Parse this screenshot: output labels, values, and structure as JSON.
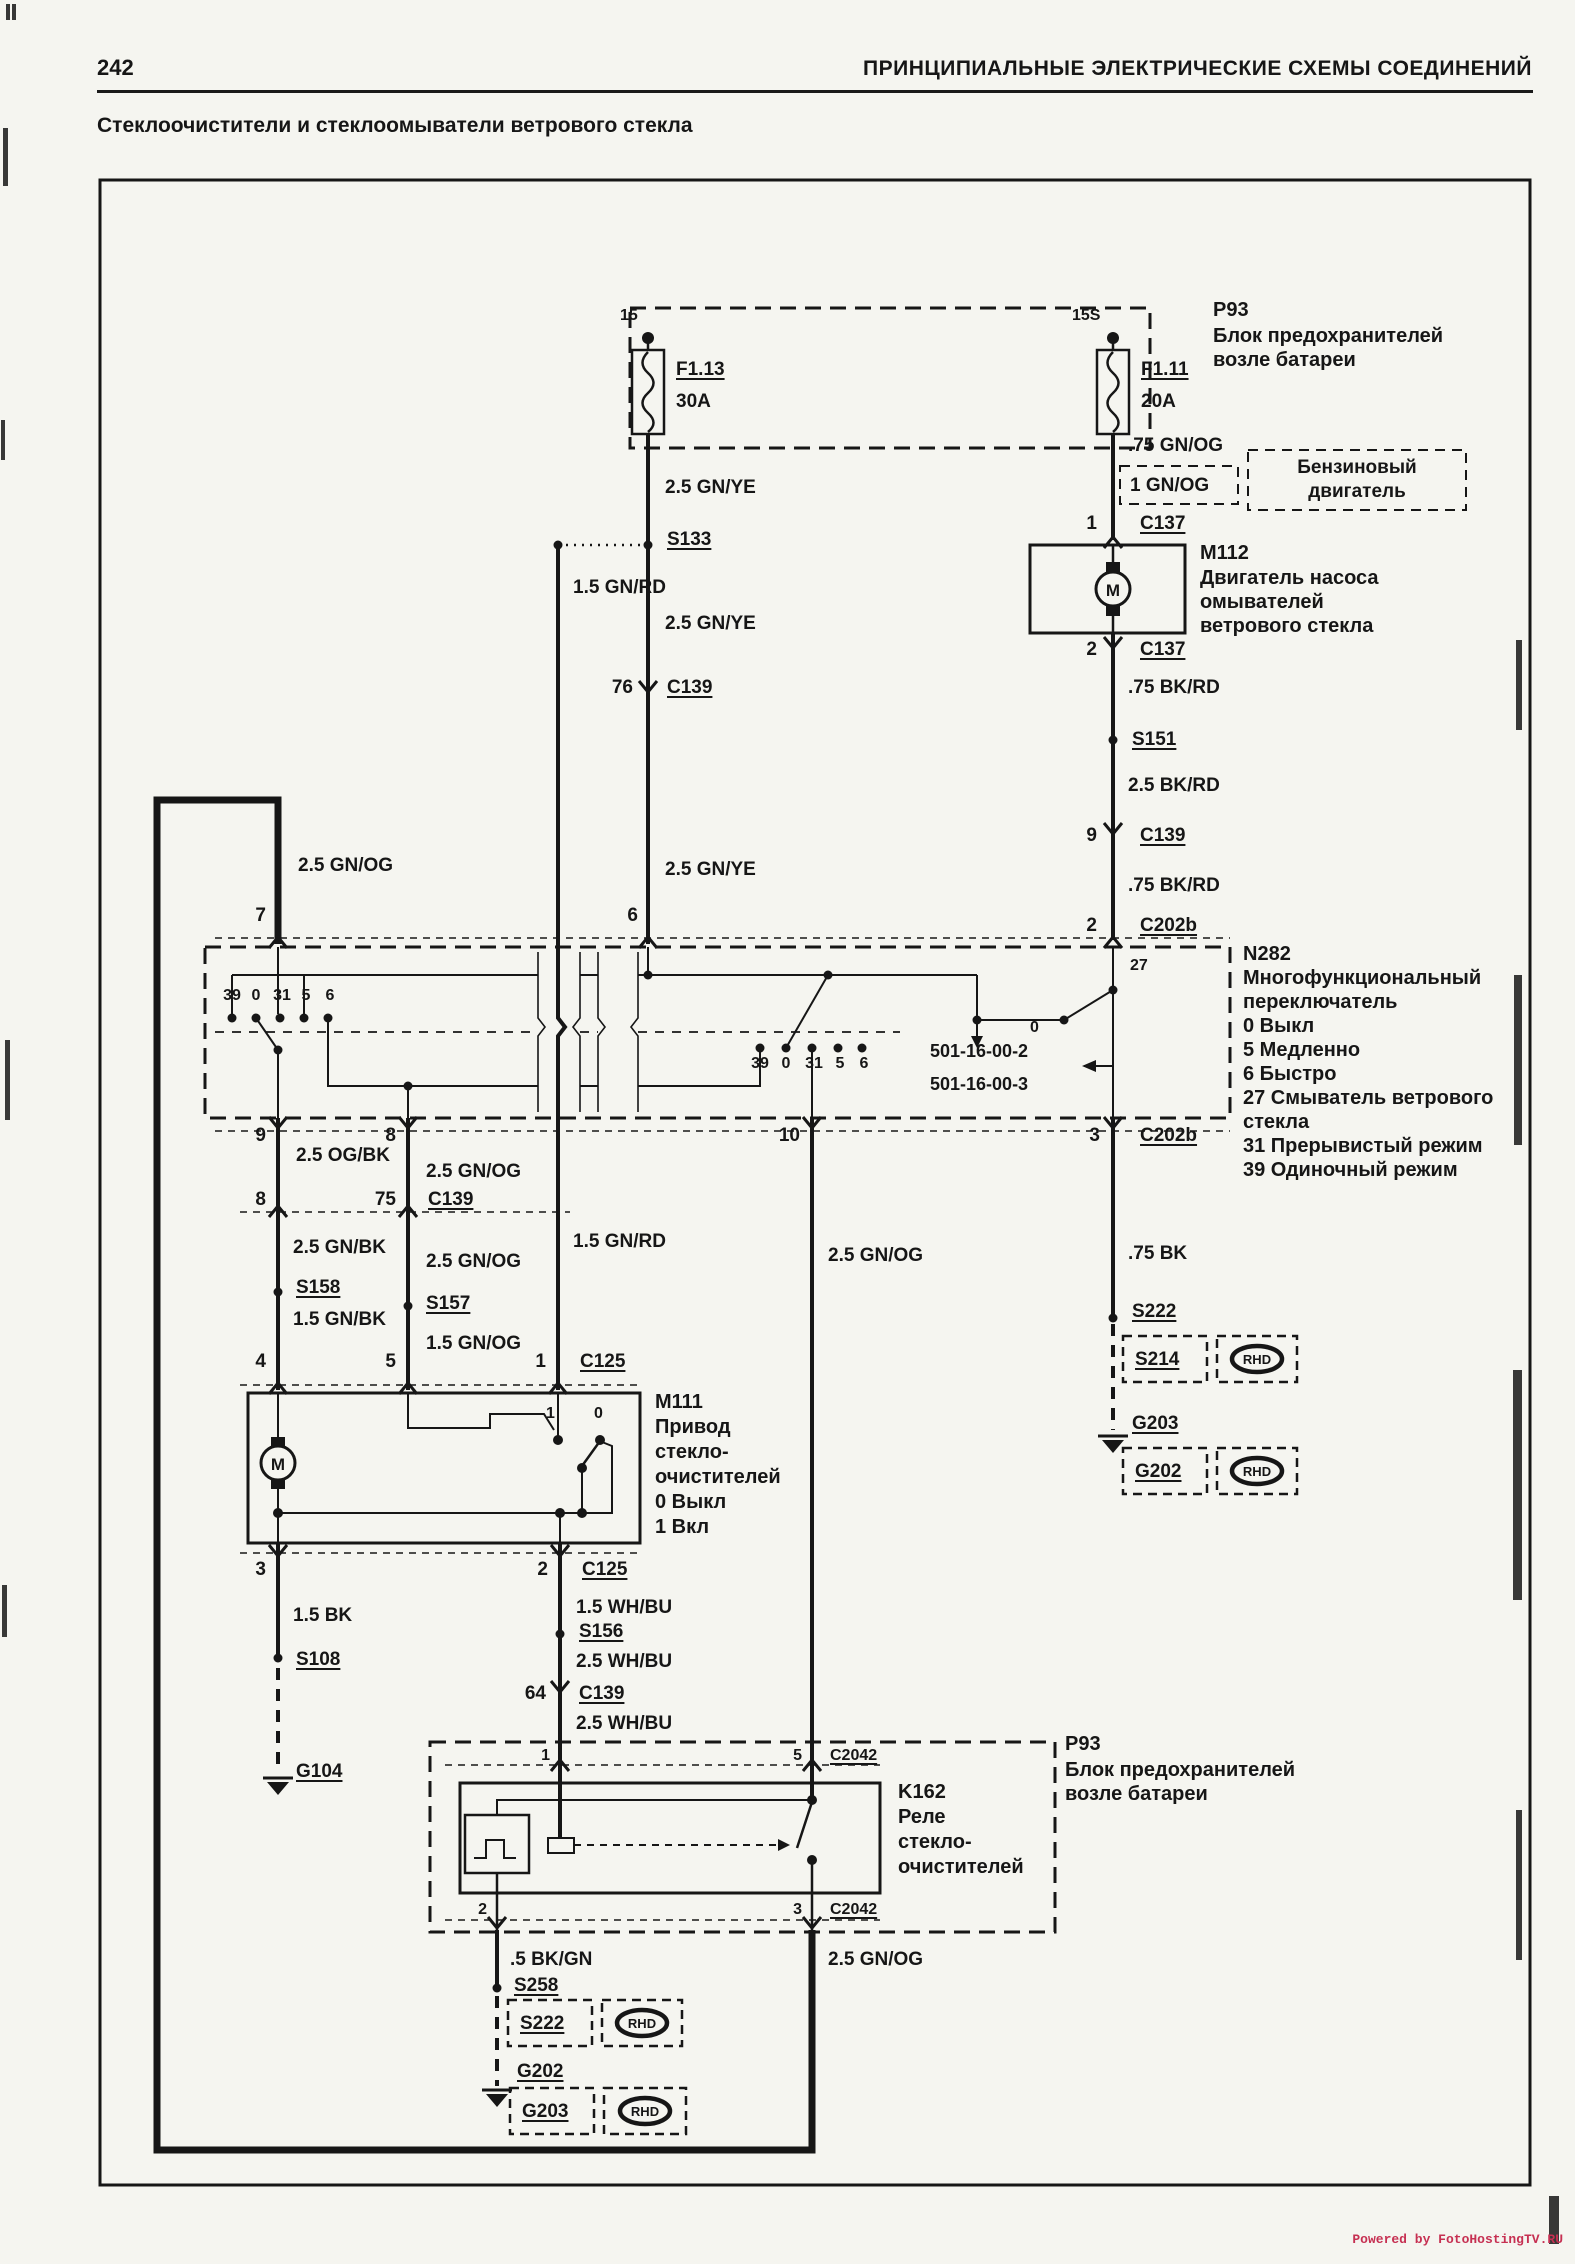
{
  "page": {
    "number": "242",
    "header": "ПРИНЦИПИАЛЬНЫЕ ЭЛЕКТРИЧЕСКИЕ СХЕМЫ СОЕДИНЕНИЙ",
    "title": "Стеклоочистители и стеклоомыватели ветрового стекла",
    "watermark": "Powered by FotoHostingTV.RU"
  },
  "colors": {
    "ink": "#161616",
    "paper": "#f5f5f0",
    "watermark": "#c63052"
  },
  "fusebox_top": {
    "id": "P93",
    "desc_line1": "Блок предохранителей",
    "desc_line2": "возле батареи",
    "fuse_left": {
      "terminal": "15",
      "name": "F1.13",
      "rating": "30A"
    },
    "fuse_right": {
      "terminal": "15S",
      "name": "F1.11",
      "rating": "20A"
    }
  },
  "washer_branch": {
    "wire_up": ".75 GN/OG",
    "wire_alt": "1 GN/OG",
    "engine_note_line1": "Бензиновый",
    "engine_note_line2": "двигатель",
    "pin_top": "1",
    "pin_bottom": "2",
    "connector_top": "C137",
    "connector_bottom": "C137",
    "motor": {
      "id": "M112",
      "symbol": "M",
      "desc_line1": "Двигатель насоса",
      "desc_line2": "омывателей",
      "desc_line3": "ветрового стекла"
    },
    "wire1": ".75 BK/RD",
    "splice": "S151",
    "wire2": "2.5 BK/RD",
    "pin_c139": "9",
    "conn_c139": "C139",
    "wire3": ".75 BK/RD",
    "pin_c202b": "2",
    "conn_c202b": "C202b"
  },
  "wiper_feed": {
    "wire1": "2.5 GN/YE",
    "splice": "S133",
    "wire2": "2.5 GN/YE",
    "pin_c139": "76",
    "conn_c139": "C139",
    "wire3": "2.5 GN/YE",
    "pin_n282": "6",
    "branch_wire": "1.5 GN/RD",
    "branch_wire2": "1.5 GN/RD"
  },
  "bus": {
    "wire_label_top": "2.5 GN/OG",
    "pin_n282": "7",
    "wire_label_bottom": "2.5 GN/OG"
  },
  "n282": {
    "id": "N282",
    "desc_line1": "Многофункциональный",
    "desc_line2": "переключатель",
    "legend": [
      "0 Выкл",
      "5 Медленно",
      "6 Быстро",
      "27 Смыватель ветрового",
      "стекла",
      "31 Прерывистый режим",
      "39 Одиночный режим"
    ],
    "sw1": [
      "39",
      "0",
      "31",
      "5",
      "6"
    ],
    "sw2": [
      "39",
      "0",
      "31",
      "5",
      "6"
    ],
    "washer_pin": "27",
    "washer_off": "0",
    "ref1": "501-16-00-2",
    "ref2": "501-16-00-3",
    "out_row": {
      "pin9": "9",
      "pin8": "8",
      "pin10": "10",
      "pin3": "3",
      "connector": "C202b"
    }
  },
  "motor_circuit": {
    "colA": {
      "wire1": "2.5 OG/BK",
      "pin_c139": "8",
      "wire2": "2.5 GN/BK",
      "splice": "S158",
      "wire3": "1.5 GN/BK",
      "pin_m111": "4"
    },
    "colB": {
      "wire1": "2.5 GN/OG",
      "pin_c139": "75",
      "conn_c139": "C139",
      "wire2": "2.5 GN/OG",
      "splice": "S157",
      "wire3": "1.5 GN/OG",
      "pin_m111": "5"
    },
    "colC": {
      "pin_m111": "1",
      "conn": "C125"
    },
    "m111": {
      "id": "M111",
      "symbol": "M",
      "desc_line1": "Привод",
      "desc_line2": "стекло-",
      "desc_line3": "очистителей",
      "legend1": "0 Выкл",
      "legend2": "1 Вкл",
      "contact1": "1",
      "contact0": "0"
    },
    "out_row": {
      "pin3": "3",
      "pin2": "2",
      "connector": "C125"
    }
  },
  "left_ground": {
    "wire": "1.5 BK",
    "splice": "S108",
    "ground": "G104"
  },
  "run_wire": {
    "wire1": "1.5 WH/BU",
    "splice": "S156",
    "wire2": "2.5 WH/BU",
    "pin_c139": "64",
    "conn_c139": "C139",
    "wire3": "2.5 WH/BU"
  },
  "relay": {
    "fusebox_id": "P93",
    "fusebox_line1": "Блок предохранителей",
    "fusebox_line2": "возле батареи",
    "id": "K162",
    "desc_line1": "Реле",
    "desc_line2": "стекло-",
    "desc_line3": "очистителей",
    "pin1": "1",
    "pin5": "5",
    "pin2": "2",
    "pin3": "3",
    "conn_top": "C2042",
    "conn_bottom": "C2042",
    "wire_in": "2.5 GN/OG",
    "wire_out": "2.5 GN/OG",
    "wire_ground": ".5 BK/GN"
  },
  "bottom_ground": {
    "splice": "S258",
    "alt_splice": "S222",
    "ground": "G202",
    "alt_ground": "G203",
    "rhd": "RHD"
  },
  "right_ground": {
    "wire": ".75 BK",
    "splice": "S222",
    "alt_splice": "S214",
    "ground": "G203",
    "alt_ground": "G202",
    "rhd": "RHD"
  }
}
